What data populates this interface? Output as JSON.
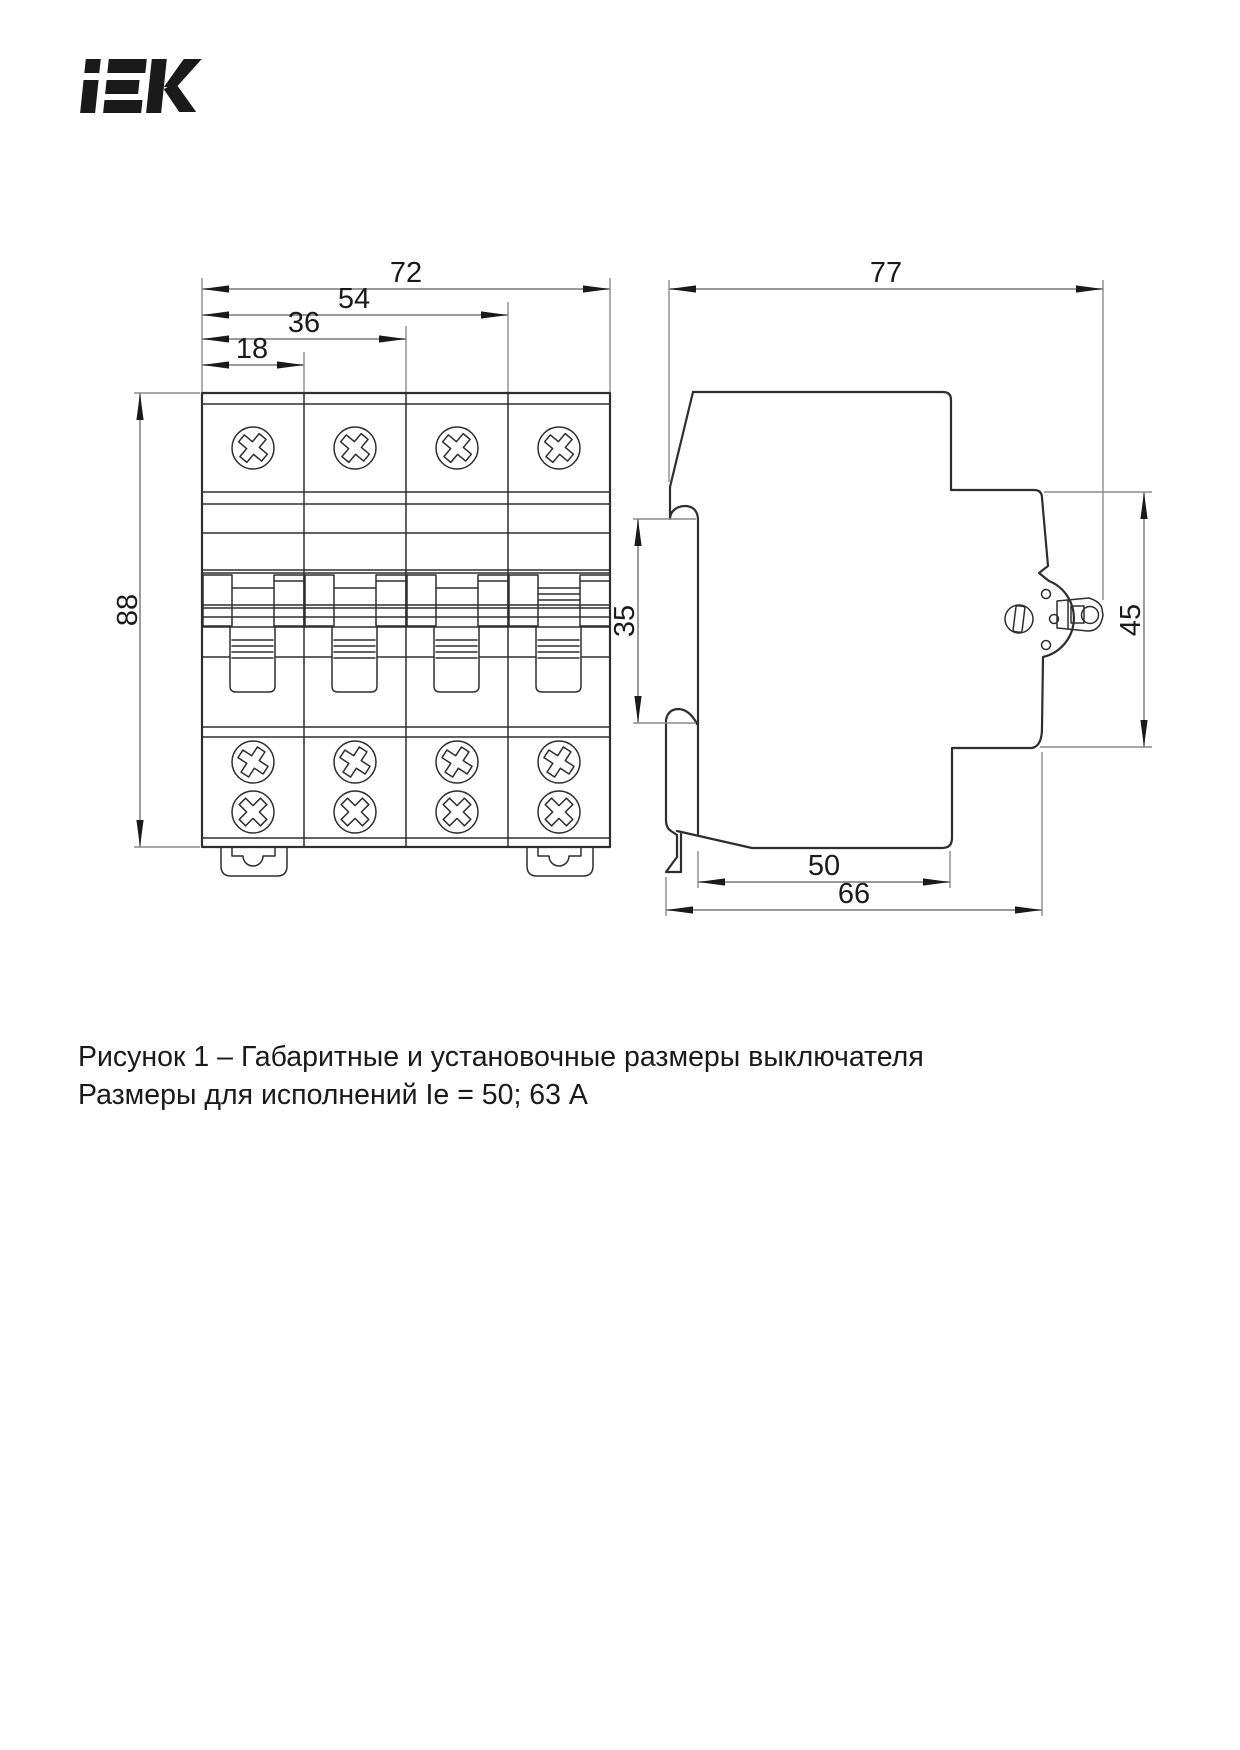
{
  "logo": {
    "brand": "IEK"
  },
  "dimensions": {
    "front": {
      "overall_width": "72",
      "three_modules": "54",
      "two_modules": "36",
      "one_module": "18",
      "height": "88"
    },
    "side": {
      "overall_depth": "77",
      "din_rail": "35",
      "front_height": "45",
      "body_depth": "50",
      "mounting_depth": "66"
    }
  },
  "caption": {
    "line1": "Рисунок 1 – Габаритные и установочные размеры выключателя",
    "line2": "Размеры для исполнений Ie = 50; 63 А"
  },
  "colors": {
    "background": "#ffffff",
    "body_line": "#2e2e2e",
    "dim_line": "#8c8c8c",
    "text": "#1a1a1a"
  }
}
